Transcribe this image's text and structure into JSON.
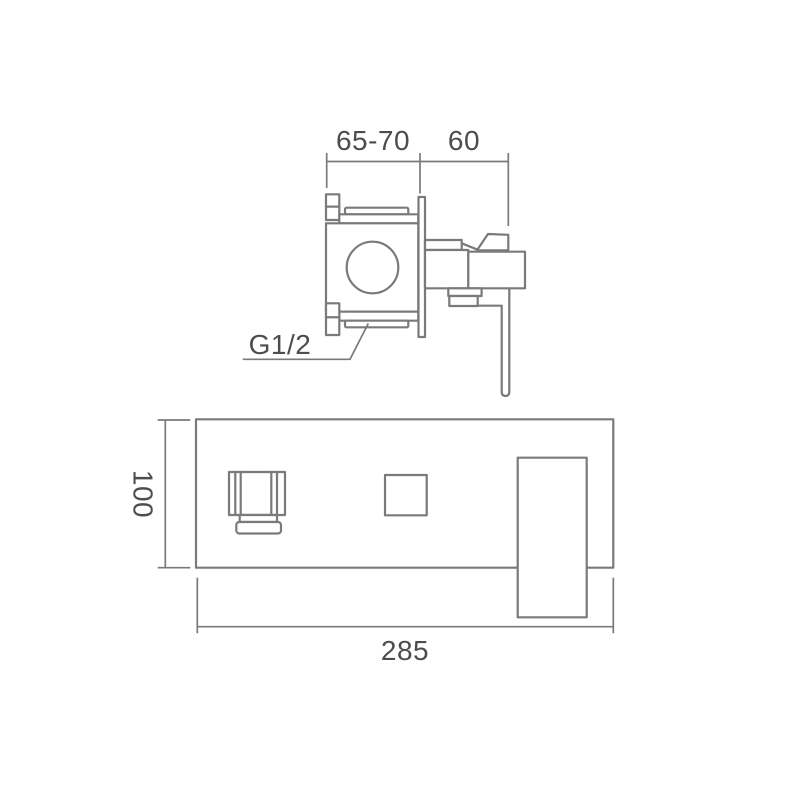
{
  "diagram": {
    "labels": {
      "valve_depth_range": "65-70",
      "handle_projection": "60",
      "inlet_thread": "G1/2",
      "plate_height": "100",
      "plate_width": "285"
    },
    "colors": {
      "line": "#7a7a7a",
      "text": "#4d4d4d",
      "background": "#ffffff"
    }
  }
}
